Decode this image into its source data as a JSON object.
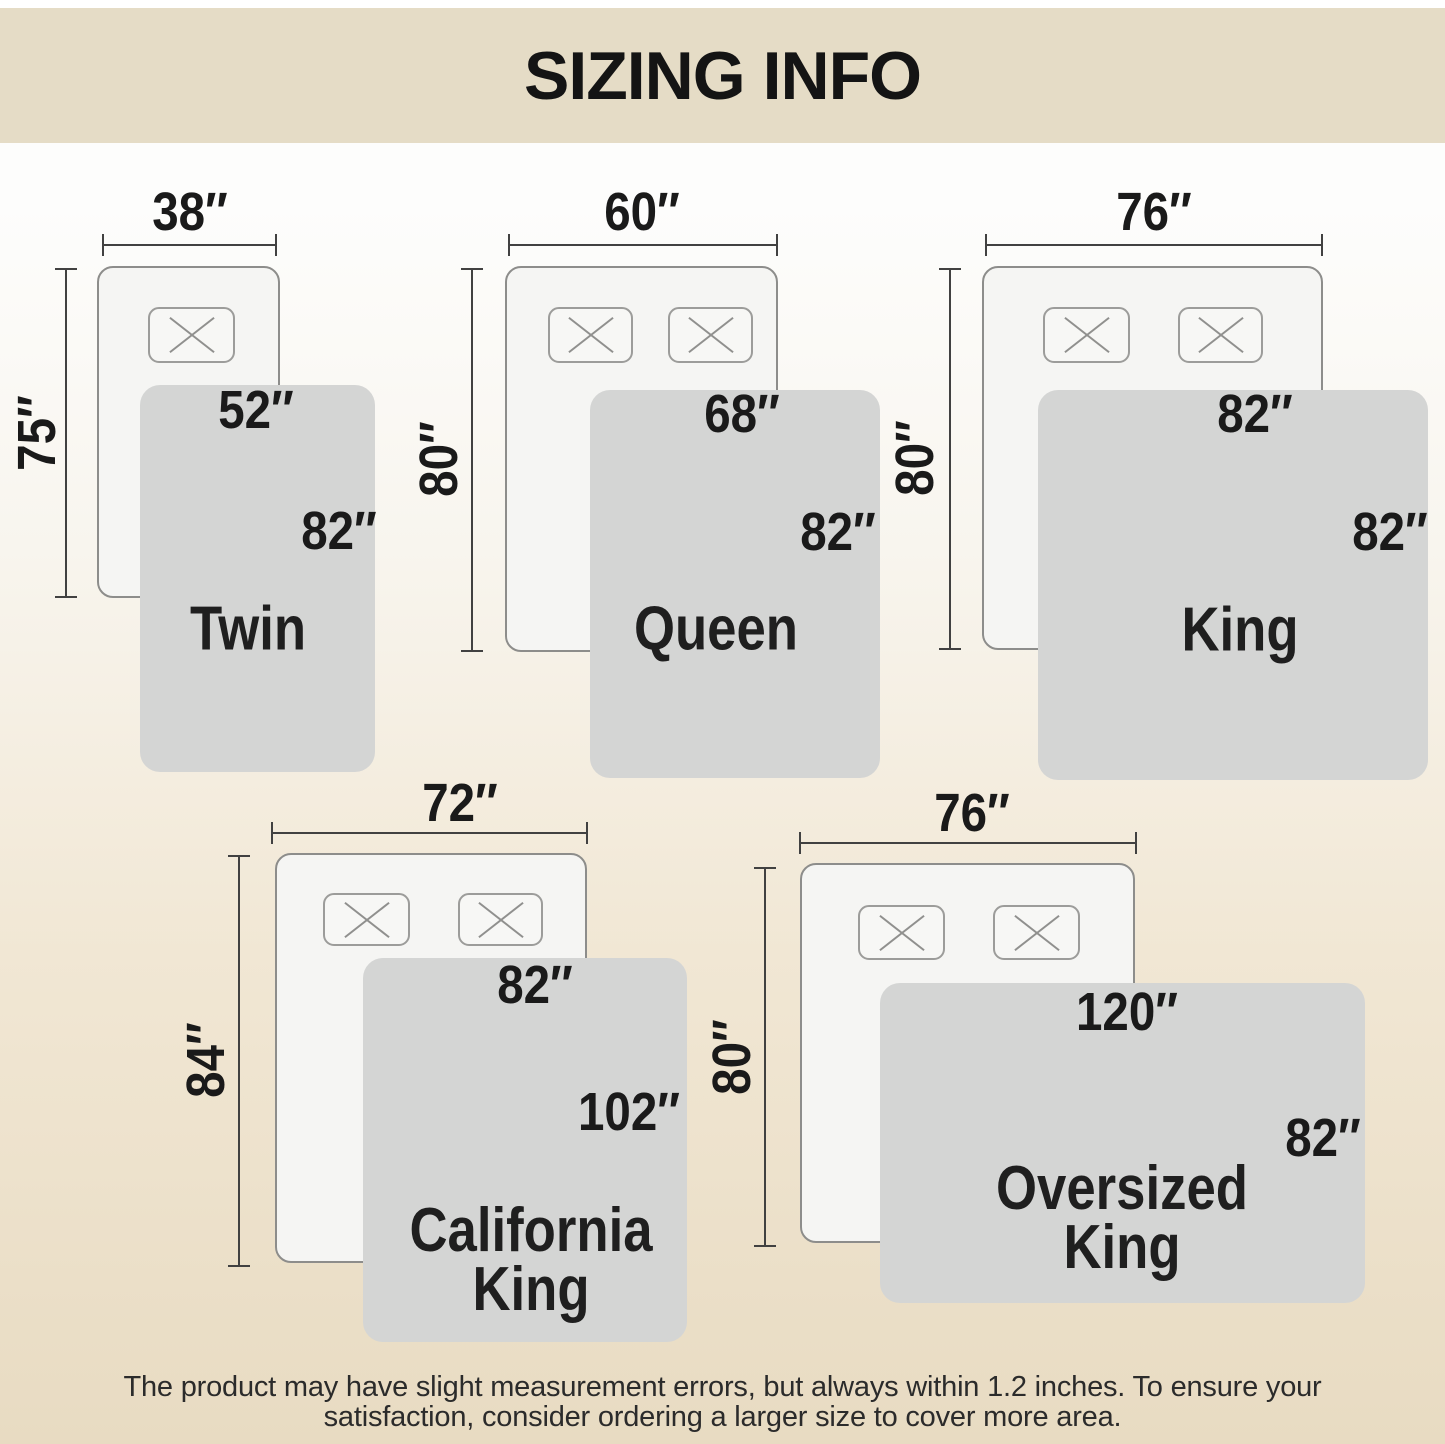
{
  "header": {
    "title": "SIZING INFO"
  },
  "sizes": [
    {
      "name": "Twin",
      "name_line1": "Twin",
      "mattress_width": "38″",
      "mattress_length": "75″",
      "blanket_width": "52″",
      "blanket_length": "82″"
    },
    {
      "name": "Queen",
      "name_line1": "Queen",
      "mattress_width": "60″",
      "mattress_length": "80″",
      "blanket_width": "68″",
      "blanket_length": "82″"
    },
    {
      "name": "King",
      "name_line1": "King",
      "mattress_width": "76″",
      "mattress_length": "80″",
      "blanket_width": "82″",
      "blanket_length": "82″"
    },
    {
      "name": "California King",
      "name_line1": "California",
      "name_line2": "King",
      "mattress_width": "72″",
      "mattress_length": "84″",
      "blanket_width": "82″",
      "blanket_length": "102″"
    },
    {
      "name": "Oversized King",
      "name_line1": "Oversized",
      "name_line2": "King",
      "mattress_width": "76″",
      "mattress_length": "80″",
      "blanket_width": "120″",
      "blanket_length": "82″"
    }
  ],
  "footer": {
    "line1": "The product may have slight measurement errors, but always within 1.2 inches. To ensure your",
    "line2": "satisfaction, consider ordering a larger size to cover more area."
  },
  "colors": {
    "header_bg": "#e5dcc6",
    "blanket_fill": "#d4d5d4",
    "mattress_fill": "#f5f5f3",
    "mattress_border": "#8d8d8b",
    "line_color": "#414141"
  }
}
